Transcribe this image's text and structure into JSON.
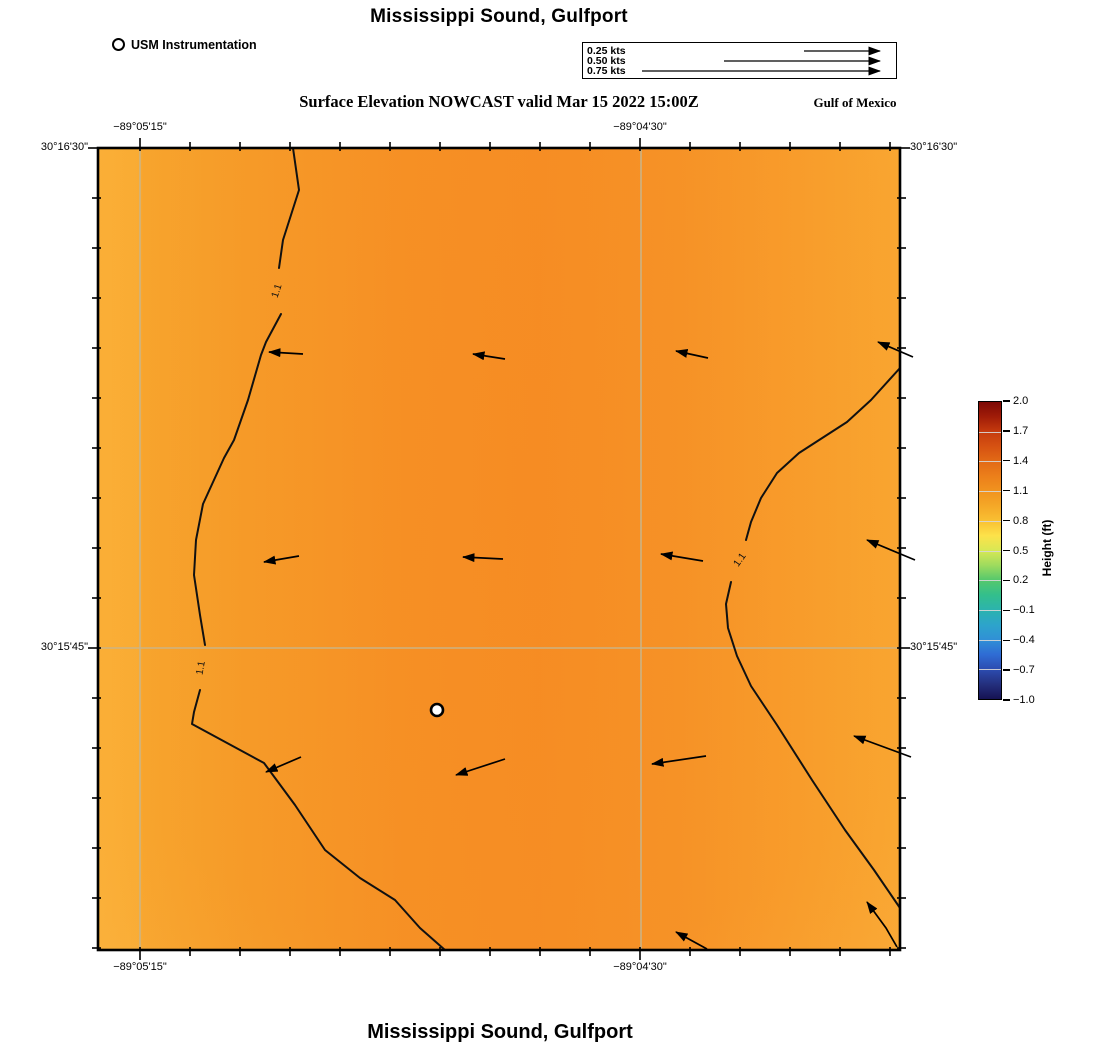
{
  "header": {
    "title": "Mississippi Sound, Gulfport",
    "instrument_legend": "USM Instrumentation",
    "velocity_legend": {
      "rows": [
        {
          "label": "0.25 kts"
        },
        {
          "label": "0.50 kts"
        },
        {
          "label": "0.75 kts"
        }
      ]
    },
    "subtitle": "Surface Elevation NOWCAST valid Mar 15 2022 15:00Z",
    "region_label": "Gulf of Mexico"
  },
  "footer": {
    "title": "Mississippi Sound, Gulfport"
  },
  "axes": {
    "top": [
      {
        "text": "−89°05'15\""
      },
      {
        "text": "−89°04'30\""
      }
    ],
    "bottom": [
      {
        "text": "−89°05'15\""
      },
      {
        "text": "−89°04'30\""
      }
    ],
    "left": [
      {
        "text": "30°16'30\""
      },
      {
        "text": "30°15'45\""
      }
    ],
    "right": [
      {
        "text": "30°16'30\""
      },
      {
        "text": "30°15'45\""
      }
    ]
  },
  "colorbar": {
    "label": "Height (ft)",
    "ticks": [
      "2.0",
      "1.7",
      "1.4",
      "1.1",
      "0.8",
      "0.5",
      "0.2",
      "−0.1",
      "−0.4",
      "−0.7",
      "−1.0"
    ]
  },
  "chart_data": {
    "type": "heatmap",
    "title": "Mississippi Sound, Gulfport",
    "subtitle": "Surface Elevation NOWCAST valid Mar 15 2022 15:00Z",
    "bottom_title": "Mississippi Sound, Gulfport",
    "region_label": "Gulf of Mexico",
    "field": "surface elevation (ft), filled contours with current vectors",
    "x_axis": {
      "ticks": [
        "−89°05'15\"",
        "−89°04'30\""
      ]
    },
    "y_axis": {
      "ticks": [
        "30°16'30\"",
        "30°15'45\""
      ]
    },
    "colorbar": {
      "label": "Height (ft)",
      "min": -1.0,
      "max": 2.0,
      "ticks": [
        2.0,
        1.7,
        1.4,
        1.1,
        0.8,
        0.5,
        0.2,
        -0.1,
        -0.4,
        -0.7,
        -1.0
      ]
    },
    "contour_level_ft": 1.1,
    "surface_elevation_approx_range_ft": [
      1.0,
      1.2
    ],
    "velocity_scale_kts": [
      0.25,
      0.5,
      0.75
    ],
    "current_direction": "westward (arrows point left / up-left)",
    "instrument_marker": "USM Instrumentation station (white circle) near map center",
    "accent_colors": {
      "map_orange": "#f68d25",
      "map_light_band": "#f9ad34",
      "gridline": "#c9b489"
    },
    "geometry": {
      "frame": {
        "x": 98,
        "y": 148,
        "w": 802,
        "h": 802
      },
      "gridlines": {
        "x": [
          140,
          641
        ],
        "y": [
          648
        ]
      },
      "ticks": {
        "x": {
          "start": 140,
          "step": 50,
          "end": 890,
          "major": [
            140,
            640
          ]
        },
        "y": {
          "start": 148,
          "step": 50,
          "end": 948,
          "major": [
            148,
            648
          ]
        }
      },
      "contours": [
        {
          "segments": [
            [
              [
                293,
                148
              ],
              [
                299,
                190
              ],
              [
                283,
                240
              ],
              [
                279,
                268
              ]
            ],
            [
              [
                281,
                314
              ],
              [
                266,
                342
              ],
              [
                261,
                355
              ],
              [
                248,
                400
              ],
              [
                234,
                440
              ],
              [
                224,
                458
              ],
              [
                203,
                504
              ],
              [
                196,
                540
              ],
              [
                194,
                575
              ],
              [
                200,
                615
              ],
              [
                205,
                645
              ]
            ],
            [
              [
                200,
                690
              ],
              [
                194,
                712
              ],
              [
                192,
                724
              ],
              [
                264,
                763
              ],
              [
                295,
                805
              ],
              [
                325,
                850
              ],
              [
                360,
                878
              ],
              [
                395,
                900
              ],
              [
                420,
                928
              ],
              [
                445,
                950
              ]
            ]
          ],
          "labels": [
            {
              "text": "1.1",
              "x": 277,
              "y": 291,
              "angle": -72
            },
            {
              "text": "1.1",
              "x": 201,
              "y": 668,
              "angle": -80
            }
          ]
        },
        {
          "segments": [
            [
              [
                900,
                368
              ],
              [
                871,
                400
              ],
              [
                847,
                422
              ],
              [
                799,
                453
              ],
              [
                777,
                473
              ],
              [
                761,
                498
              ],
              [
                751,
                522
              ],
              [
                746,
                540
              ]
            ],
            [
              [
                731,
                582
              ],
              [
                726,
                604
              ],
              [
                728,
                628
              ],
              [
                737,
                656
              ],
              [
                751,
                686
              ],
              [
                777,
                725
              ],
              [
                812,
                780
              ],
              [
                845,
                830
              ],
              [
                874,
                870
              ],
              [
                900,
                908
              ]
            ]
          ],
          "labels": [
            {
              "text": "1.1",
              "x": 740,
              "y": 560,
              "angle": -55
            }
          ]
        }
      ],
      "arrows": [
        [
          [
            303,
            354
          ],
          [
            269,
            352
          ]
        ],
        [
          [
            505,
            359
          ],
          [
            473,
            354
          ]
        ],
        [
          [
            708,
            358
          ],
          [
            676,
            351
          ]
        ],
        [
          [
            913,
            357
          ],
          [
            878,
            342
          ]
        ],
        [
          [
            299,
            556
          ],
          [
            264,
            562
          ]
        ],
        [
          [
            503,
            559
          ],
          [
            463,
            557
          ]
        ],
        [
          [
            703,
            561
          ],
          [
            661,
            554
          ]
        ],
        [
          [
            915,
            560
          ],
          [
            867,
            540
          ]
        ],
        [
          [
            301,
            757
          ],
          [
            266,
            772
          ]
        ],
        [
          [
            505,
            759
          ],
          [
            456,
            775
          ]
        ],
        [
          [
            706,
            756
          ],
          [
            652,
            764
          ]
        ],
        [
          [
            911,
            757
          ],
          [
            854,
            736
          ]
        ],
        [
          [
            707,
            949
          ],
          [
            676,
            932
          ]
        ],
        [
          [
            897,
            947
          ],
          [
            886,
            928
          ],
          [
            867,
            902
          ]
        ]
      ],
      "instrument": {
        "x": 437,
        "y": 710,
        "r": 6
      },
      "colorbar_box": {
        "x": 978,
        "y": 401,
        "w": 24,
        "h": 299
      }
    }
  }
}
